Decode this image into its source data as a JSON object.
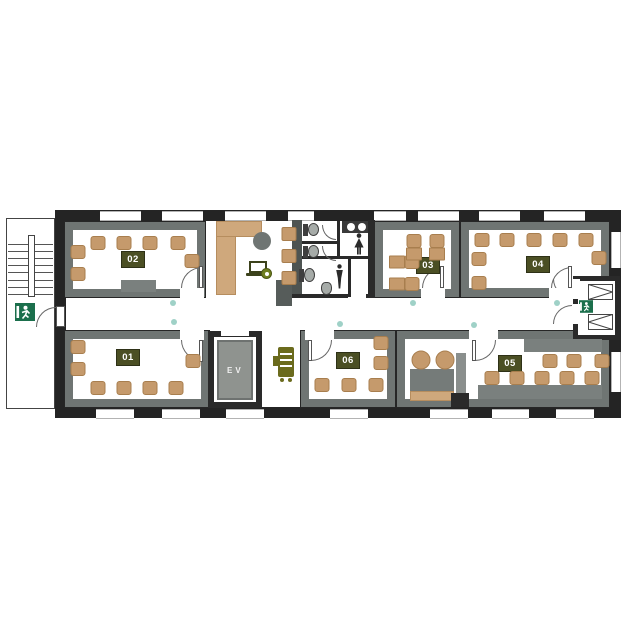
{
  "title": "Office floor plan",
  "rooms": [
    {
      "id": "room-01",
      "label": "01"
    },
    {
      "id": "room-02",
      "label": "02"
    },
    {
      "id": "room-03",
      "label": "03"
    },
    {
      "id": "room-04",
      "label": "04"
    },
    {
      "id": "room-05",
      "label": "05"
    },
    {
      "id": "room-06",
      "label": "06"
    }
  ],
  "elevator": {
    "label": "EV"
  },
  "colors": {
    "outer_wall": "#242424",
    "room_wall_band": "#6f7573",
    "wood_tan": "#cfa87c",
    "chair_tan": "#c59a6c",
    "label_olive": "#4b4f24",
    "exit_green": "#1b6f4c",
    "sensor_dot_teal": "#9fd1c7",
    "fixture_gray": "#a6aba8",
    "device_olive": "#6b6b1d"
  },
  "icons": [
    "exit-sign",
    "stairs",
    "toilet",
    "urinal",
    "sink",
    "woman-pictogram",
    "man-pictogram",
    "laptop",
    "coffee-cup",
    "copier",
    "elevator"
  ],
  "furniture": {
    "chairs": [
      [
        98,
        243
      ],
      [
        124,
        243
      ],
      [
        150,
        243
      ],
      [
        178,
        243
      ],
      [
        78,
        252
      ],
      [
        78,
        274
      ],
      [
        192,
        261
      ],
      [
        78,
        347
      ],
      [
        78,
        369
      ],
      [
        98,
        388
      ],
      [
        124,
        388
      ],
      [
        150,
        388
      ],
      [
        176,
        388
      ],
      [
        193,
        361
      ],
      [
        414,
        241
      ],
      [
        437,
        241
      ],
      [
        412,
        262
      ],
      [
        412,
        284
      ],
      [
        482,
        240
      ],
      [
        507,
        240
      ],
      [
        534,
        240
      ],
      [
        560,
        240
      ],
      [
        586,
        240
      ],
      [
        479,
        259
      ],
      [
        479,
        283
      ],
      [
        599,
        258
      ],
      [
        381,
        343
      ],
      [
        381,
        363
      ],
      [
        322,
        385
      ],
      [
        349,
        385
      ],
      [
        376,
        385
      ],
      [
        550,
        361
      ],
      [
        574,
        361
      ],
      [
        602,
        361
      ],
      [
        492,
        378
      ],
      [
        517,
        378
      ],
      [
        542,
        378
      ],
      [
        567,
        378
      ],
      [
        592,
        378
      ]
    ],
    "desk_squares": [
      [
        414,
        254
      ],
      [
        437,
        254
      ],
      [
        397,
        262
      ],
      [
        397,
        284
      ]
    ],
    "stools": [
      [
        289,
        234
      ],
      [
        289,
        256
      ],
      [
        289,
        278
      ]
    ],
    "round_chairs": [
      [
        421,
        360
      ],
      [
        445,
        360
      ]
    ],
    "dots": [
      [
        173,
        303
      ],
      [
        174,
        322
      ],
      [
        340,
        324
      ],
      [
        413,
        303
      ],
      [
        474,
        325
      ],
      [
        557,
        303
      ]
    ]
  }
}
